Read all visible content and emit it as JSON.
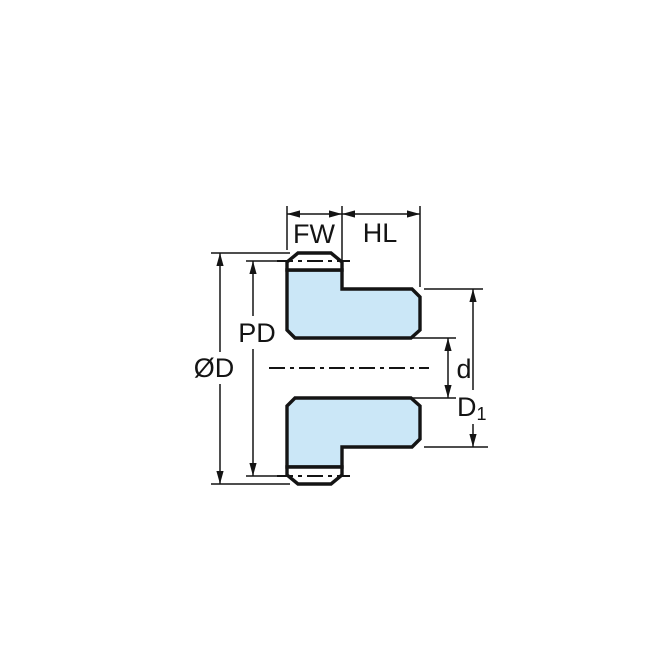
{
  "labels": {
    "face_width": "FW",
    "hub_length": "HL",
    "outside_diameter": "ØD",
    "pitch_diameter": "PD",
    "bore_diameter": "d",
    "hub_diameter_base": "D",
    "hub_diameter_subscript": "1"
  },
  "colors": {
    "body_fill": "#CBE7F7",
    "tooth_fill": "#FFFFFF",
    "line": "#141414"
  }
}
